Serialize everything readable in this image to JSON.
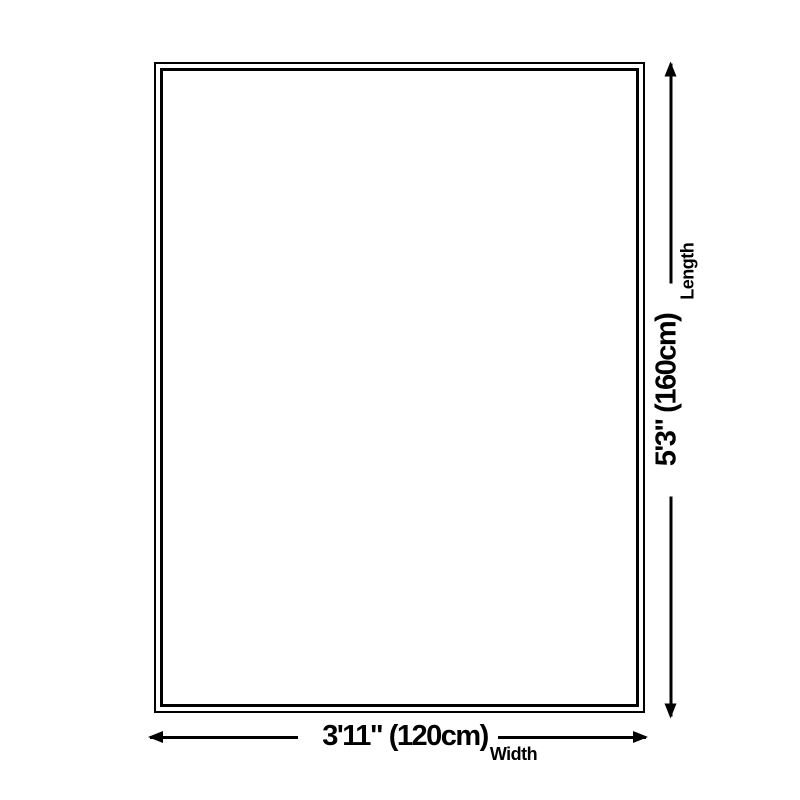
{
  "page": {
    "background_color": "#ffffff",
    "ink_color": "#000000"
  },
  "diagram": {
    "type": "product-size-diagram",
    "outline": {
      "shape": "rectangle",
      "border_style": "double",
      "border_color": "#000000",
      "fill": "#ffffff"
    },
    "dimensions": {
      "width": {
        "value": "3'11\" (120cm)",
        "label": "Width",
        "arrow_icons": [
          "arrow-left",
          "arrow-right"
        ]
      },
      "length": {
        "value": "5'3\" (160cm)",
        "label": "Length",
        "arrow_icons": [
          "arrow-up",
          "arrow-down"
        ]
      }
    }
  }
}
